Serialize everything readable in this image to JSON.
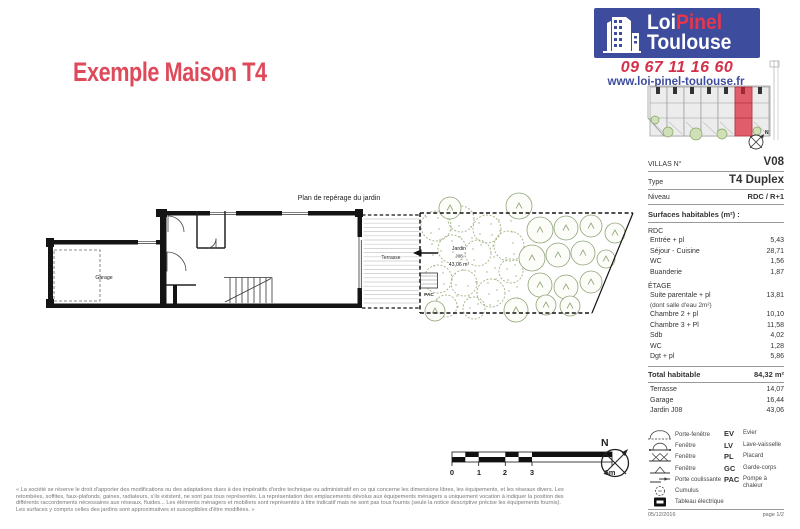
{
  "header": {
    "title": "Exemple Maison T4",
    "logo_line1_a": "Loi",
    "logo_line1_b": "Pinel",
    "logo_line2": "Toulouse",
    "phone": "09 67 11 16 60",
    "website": "www.loi-pinel-toulouse.fr"
  },
  "plan": {
    "title": "Plan de repérage du jardin",
    "labels": {
      "garage": "Garage",
      "terrasse": "Terrasse",
      "jardin_name": "Jardin",
      "jardin_ref": "J08",
      "jardin_area": "43,06 m²",
      "pac": "PAC"
    }
  },
  "scalebar": {
    "ticks": [
      "0",
      "1",
      "2",
      "3",
      "6m"
    ]
  },
  "compass": {
    "north": "N"
  },
  "siteplan": {
    "compass_north": "N"
  },
  "sidebar": {
    "info_rows": [
      {
        "label": "VILLAS N°",
        "value": "V08"
      },
      {
        "label": "Type",
        "value": "T4 Duplex"
      },
      {
        "label": "Niveau",
        "value": "RDC / R+1"
      }
    ],
    "surfaces_title": "Surfaces habitables (m²) :",
    "sections": [
      {
        "title": "RDC",
        "rows": [
          {
            "label": "Entrée + pl",
            "value": "5,43"
          },
          {
            "label": "Séjour - Cuisine",
            "value": "28,71"
          },
          {
            "label": "WC",
            "value": "1,56"
          },
          {
            "label": "Buanderie",
            "value": "1,87"
          }
        ]
      },
      {
        "title": "ÉTAGE",
        "rows": [
          {
            "label": "Suite parentale + pl",
            "value": "13,81"
          },
          {
            "label": "(dont salle d'eau 2m²)",
            "value": ""
          },
          {
            "label": "Chambre 2 + pl",
            "value": "10,10"
          },
          {
            "label": "Chambre 3 + Pl",
            "value": "11,58"
          },
          {
            "label": "Sdb",
            "value": "4,02"
          },
          {
            "label": "WC",
            "value": "1,28"
          },
          {
            "label": "Dgt + pl",
            "value": "5,86"
          }
        ]
      }
    ],
    "total": {
      "label": "Total habitable",
      "value": "84,32 m²"
    },
    "extra_rows": [
      {
        "label": "Terrasse",
        "value": "14,07"
      },
      {
        "label": "Garage",
        "value": "16,44"
      },
      {
        "label": "Jardin J08",
        "value": "43,06"
      }
    ]
  },
  "legend": {
    "symbols": [
      {
        "icon": "porte-fenetre",
        "label": "Porte-fenêtre"
      },
      {
        "icon": "fenetre-arcs",
        "label": "Fenêtre"
      },
      {
        "icon": "fenetre-double",
        "label": "Fenêtre"
      },
      {
        "icon": "fenetre-simple",
        "label": "Fenêtre"
      },
      {
        "icon": "porte-coulissante",
        "label": "Porte coulissante"
      },
      {
        "icon": "cumulus",
        "label": "Cumulus"
      },
      {
        "icon": "tableau-electrique",
        "label": "Tableau électrique"
      }
    ],
    "abbreviations": [
      {
        "abbr": "EV",
        "label": "Evier"
      },
      {
        "abbr": "LV",
        "label": "Lave-vaisselle"
      },
      {
        "abbr": "PL",
        "label": "Placard"
      },
      {
        "abbr": "GC",
        "label": "Garde-corps"
      },
      {
        "abbr": "PAC",
        "label": "Pompe à chaleur"
      }
    ]
  },
  "footer": {
    "date": "05/12/2016",
    "page": "page 1/2"
  },
  "disclaimer": [
    "« La société se réserve le droit d'apporter des modifications ou des adaptations dues à des impératifs d'ordre technique ou administratif en ce qui concerne les dimensions libres, les équipements, et les réseaux divers. Les",
    "retombées, soffites, faux-plafonds, gaines, radiateurs, s'ils existent, ne sont pas tous représentés. La représentation des emplacements dévolus aux équipements ménagers a uniquement vocation à indiquer la position des",
    "différents raccordements nécessaires aux réseaux, fluides... Les éléments ménagers et mobiliers sont représentés à titre indicatif mais ne sont pas tous fournis (seule la notice descriptive précise les équipements fournis).",
    "Les surfaces y compris celles des jardins sont approximatives et susceptibles d'être modifiées. »"
  ]
}
